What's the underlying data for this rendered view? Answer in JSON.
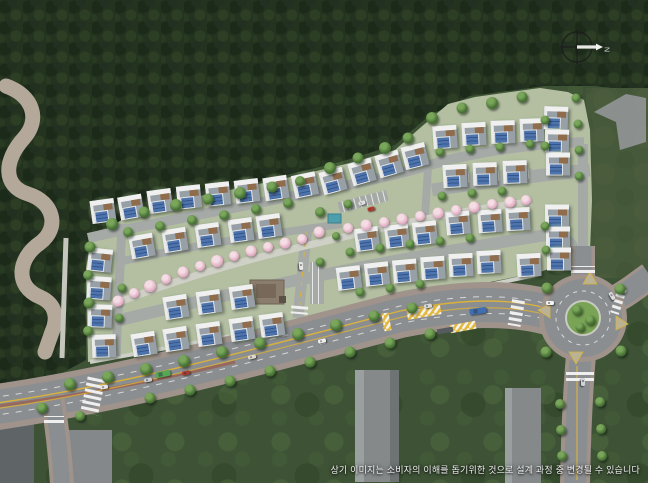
{
  "caption": "상기 이미지는 소비자의 이해를 돕기위한 것으로 설계 과정 중 변경될 수 있습니다",
  "compass": {
    "label": "N"
  },
  "site_plan": {
    "legend": "single-family housing complex site plan with solar roofs, central cherry-tree walkway, perimeter forest, main road with bus stop and roundabout",
    "accent_colors": {
      "forest": "#24331f",
      "meadow": "#47593b",
      "development_ground": "#b4bfa2",
      "road": "#8b8e91",
      "sidewalk": "#9f938b",
      "solar_panel": "#4e74ad",
      "cherry": "#e3b1c5",
      "lane_yellow": "#d9b23c"
    },
    "houses": [
      [
        103,
        211,
        -8
      ],
      [
        131,
        207,
        -10
      ],
      [
        160,
        201,
        -8
      ],
      [
        189,
        197,
        -6
      ],
      [
        218,
        194,
        -6
      ],
      [
        247,
        191,
        -7
      ],
      [
        276,
        188,
        -9
      ],
      [
        305,
        185,
        -12
      ],
      [
        333,
        181,
        -15
      ],
      [
        362,
        172,
        -16
      ],
      [
        389,
        164,
        -16
      ],
      [
        415,
        156,
        -14
      ],
      [
        445,
        137,
        -4
      ],
      [
        474,
        134,
        -3
      ],
      [
        503,
        132,
        -2
      ],
      [
        532,
        130,
        -2
      ],
      [
        455,
        176,
        -3
      ],
      [
        485,
        174,
        -2
      ],
      [
        515,
        172,
        -2
      ],
      [
        556,
        118,
        2
      ],
      [
        557,
        141,
        1
      ],
      [
        558,
        164,
        0
      ],
      [
        557,
        216,
        0
      ],
      [
        558,
        238,
        0
      ],
      [
        559,
        259,
        0
      ],
      [
        529,
        265,
        -3
      ],
      [
        100,
        260,
        6
      ],
      [
        99,
        288,
        4
      ],
      [
        100,
        316,
        2
      ],
      [
        104,
        346,
        -2
      ],
      [
        142,
        246,
        -10
      ],
      [
        175,
        240,
        -9
      ],
      [
        208,
        235,
        -8
      ],
      [
        241,
        230,
        -8
      ],
      [
        269,
        226,
        -8
      ],
      [
        367,
        239,
        -8
      ],
      [
        397,
        236,
        -7
      ],
      [
        425,
        233,
        -6
      ],
      [
        458,
        223,
        -5
      ],
      [
        490,
        221,
        -4
      ],
      [
        518,
        219,
        -3
      ],
      [
        176,
        307,
        -9
      ],
      [
        209,
        302,
        -8
      ],
      [
        242,
        297,
        -8
      ],
      [
        144,
        344,
        -9
      ],
      [
        176,
        339,
        -9
      ],
      [
        209,
        334,
        -8
      ],
      [
        242,
        329,
        -8
      ],
      [
        272,
        325,
        -8
      ],
      [
        349,
        278,
        -7
      ],
      [
        377,
        274,
        -6
      ],
      [
        405,
        271,
        -5
      ],
      [
        433,
        268,
        -4
      ],
      [
        461,
        265,
        -3
      ],
      [
        489,
        262,
        -3
      ]
    ],
    "trees": [
      [
        112,
        224,
        12
      ],
      [
        144,
        212,
        11
      ],
      [
        176,
        205,
        12
      ],
      [
        208,
        199,
        11
      ],
      [
        240,
        193,
        12
      ],
      [
        272,
        187,
        11
      ],
      [
        300,
        181,
        10
      ],
      [
        330,
        168,
        12
      ],
      [
        358,
        158,
        11
      ],
      [
        385,
        148,
        12
      ],
      [
        408,
        138,
        11
      ],
      [
        432,
        118,
        12
      ],
      [
        462,
        108,
        11
      ],
      [
        492,
        103,
        12
      ],
      [
        522,
        97,
        11
      ],
      [
        128,
        232,
        10
      ],
      [
        160,
        226,
        10
      ],
      [
        192,
        220,
        10
      ],
      [
        224,
        215,
        10
      ],
      [
        256,
        209,
        10
      ],
      [
        288,
        203,
        10
      ],
      [
        90,
        247,
        11
      ],
      [
        88,
        275,
        10
      ],
      [
        89,
        303,
        11
      ],
      [
        88,
        331,
        10
      ],
      [
        122,
        288,
        9
      ],
      [
        119,
        318,
        9
      ],
      [
        320,
        212,
        10
      ],
      [
        348,
        204,
        9
      ],
      [
        336,
        236,
        8
      ],
      [
        440,
        152,
        9
      ],
      [
        470,
        149,
        9
      ],
      [
        500,
        147,
        9
      ],
      [
        530,
        144,
        9
      ],
      [
        442,
        196,
        9
      ],
      [
        472,
        193,
        9
      ],
      [
        502,
        191,
        9
      ],
      [
        350,
        252,
        9
      ],
      [
        380,
        248,
        9
      ],
      [
        410,
        244,
        9
      ],
      [
        440,
        241,
        9
      ],
      [
        470,
        238,
        9
      ],
      [
        320,
        262,
        9
      ],
      [
        360,
        292,
        9
      ],
      [
        390,
        288,
        9
      ],
      [
        420,
        284,
        9
      ],
      [
        545,
        120,
        9
      ],
      [
        545,
        146,
        9
      ],
      [
        576,
        98,
        9
      ],
      [
        578,
        124,
        9
      ],
      [
        579,
        150,
        9
      ],
      [
        579,
        176,
        9
      ],
      [
        545,
        226,
        9
      ],
      [
        546,
        250,
        9
      ],
      [
        70,
        384,
        12
      ],
      [
        108,
        377,
        12
      ],
      [
        146,
        369,
        12
      ],
      [
        184,
        361,
        12
      ],
      [
        222,
        352,
        12
      ],
      [
        260,
        343,
        12
      ],
      [
        298,
        334,
        12
      ],
      [
        336,
        325,
        12
      ],
      [
        374,
        316,
        11
      ],
      [
        412,
        308,
        11
      ],
      [
        150,
        398,
        11
      ],
      [
        190,
        390,
        11
      ],
      [
        230,
        381,
        11
      ],
      [
        270,
        371,
        11
      ],
      [
        310,
        362,
        11
      ],
      [
        350,
        352,
        11
      ],
      [
        390,
        343,
        11
      ],
      [
        430,
        334,
        11
      ],
      [
        547,
        288,
        11
      ],
      [
        620,
        289,
        11
      ],
      [
        546,
        352,
        11
      ],
      [
        621,
        351,
        11
      ],
      [
        577,
        310,
        10
      ],
      [
        590,
        320,
        10
      ],
      [
        580,
        327,
        9
      ],
      [
        560,
        404,
        10
      ],
      [
        561,
        430,
        10
      ],
      [
        562,
        456,
        10
      ],
      [
        600,
        402,
        10
      ],
      [
        601,
        429,
        10
      ],
      [
        602,
        456,
        10
      ],
      [
        42,
        408,
        11
      ],
      [
        80,
        416,
        10
      ]
    ],
    "cherry_trees": [
      [
        118,
        301,
        11
      ],
      [
        134,
        293,
        10
      ],
      [
        150,
        286,
        12
      ],
      [
        166,
        279,
        10
      ],
      [
        183,
        272,
        11
      ],
      [
        200,
        266,
        10
      ],
      [
        217,
        261,
        12
      ],
      [
        234,
        256,
        10
      ],
      [
        251,
        251,
        11
      ],
      [
        268,
        247,
        10
      ],
      [
        285,
        243,
        11
      ],
      [
        302,
        239,
        10
      ],
      [
        319,
        232,
        11
      ],
      [
        348,
        228,
        10
      ],
      [
        366,
        225,
        11
      ],
      [
        384,
        222,
        10
      ],
      [
        402,
        219,
        11
      ],
      [
        420,
        216,
        10
      ],
      [
        438,
        213,
        11
      ],
      [
        456,
        210,
        10
      ],
      [
        474,
        207,
        11
      ],
      [
        492,
        204,
        10
      ],
      [
        510,
        202,
        11
      ],
      [
        526,
        200,
        10
      ]
    ],
    "cars": [
      [
        104,
        387,
        -9,
        "#e6e6e6",
        8,
        4
      ],
      [
        148,
        380,
        -10,
        "#c9cccf",
        8,
        4
      ],
      [
        186,
        373,
        -11,
        "#a93b30",
        8,
        4
      ],
      [
        252,
        357,
        -12,
        "#ddd9cc",
        8,
        4
      ],
      [
        322,
        341,
        -13,
        "#f0f0f0",
        8,
        4
      ],
      [
        428,
        306,
        -8,
        "#d6d8da",
        8,
        4
      ],
      [
        478,
        311,
        -8,
        "#3f6fb0",
        17,
        6
      ],
      [
        163,
        374,
        -11,
        "#57a557",
        15,
        6
      ],
      [
        550,
        303,
        0,
        "#f2f2f2",
        8,
        4
      ],
      [
        612,
        296,
        60,
        "#dcdcdc",
        8,
        4
      ],
      [
        362,
        203,
        -15,
        "#e0e0e0",
        7,
        4
      ],
      [
        371,
        209,
        -15,
        "#b03a2e",
        7,
        4
      ],
      [
        301,
        266,
        86,
        "#e8e8e8",
        8,
        4
      ],
      [
        583,
        382,
        90,
        "#d0d3d5",
        8,
        4
      ]
    ]
  }
}
